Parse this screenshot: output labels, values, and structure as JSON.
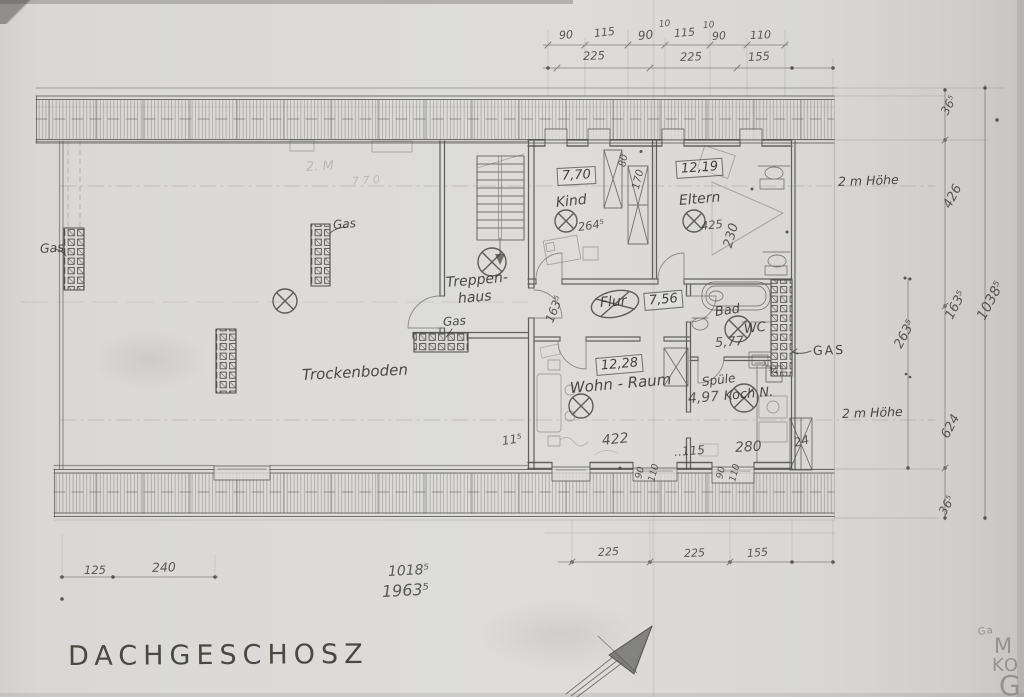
{
  "title": {
    "text": "DACHGESCHOSZ"
  },
  "plan": {
    "annotations": [
      {
        "name": "dim-top-90-a",
        "text": "90",
        "x": 559,
        "y": 30,
        "size": 11,
        "rot": -4,
        "cls": "dim"
      },
      {
        "name": "dim-top-115-a",
        "text": "115",
        "x": 594,
        "y": 28,
        "size": 11,
        "rot": -6,
        "cls": "dim"
      },
      {
        "name": "dim-top-90-b",
        "text": "90",
        "x": 638,
        "y": 30,
        "size": 12,
        "rot": -6,
        "cls": "dim"
      },
      {
        "name": "dim-top-10-a",
        "text": "10",
        "x": 659,
        "y": 21,
        "size": 9,
        "rot": -6,
        "cls": "dim"
      },
      {
        "name": "dim-top-115-b",
        "text": "115",
        "x": 674,
        "y": 28,
        "size": 11,
        "rot": -4,
        "cls": "dim"
      },
      {
        "name": "dim-top-10-b",
        "text": "10",
        "x": 703,
        "y": 22,
        "size": 9,
        "rot": -4,
        "cls": "dim"
      },
      {
        "name": "dim-top-90-c",
        "text": "90",
        "x": 712,
        "y": 31,
        "size": 11,
        "rot": -4,
        "cls": "dim"
      },
      {
        "name": "dim-top-110",
        "text": "110",
        "x": 750,
        "y": 30,
        "size": 11,
        "rot": -2,
        "cls": "dim"
      },
      {
        "name": "dim-top-225-a",
        "text": "225",
        "x": 583,
        "y": 51,
        "size": 11.5,
        "rot": -2,
        "cls": "dim"
      },
      {
        "name": "dim-top-225-b",
        "text": "225",
        "x": 680,
        "y": 52,
        "size": 11.5,
        "rot": -2,
        "cls": "dim"
      },
      {
        "name": "dim-top-155",
        "text": "155",
        "x": 748,
        "y": 52,
        "size": 11.5,
        "rot": -3,
        "cls": "dim"
      },
      {
        "name": "dim-bottom-225-a",
        "text": "225",
        "x": 598,
        "y": 547,
        "size": 11,
        "rot": -3,
        "cls": "dim"
      },
      {
        "name": "dim-bottom-225-b",
        "text": "225",
        "x": 684,
        "y": 548,
        "size": 11,
        "rot": -2,
        "cls": "dim"
      },
      {
        "name": "dim-bottom-155",
        "text": "155",
        "x": 747,
        "y": 548,
        "size": 11,
        "rot": -4,
        "cls": "dim"
      },
      {
        "name": "dim-bottom-125",
        "text": "125",
        "x": 84,
        "y": 565,
        "size": 11.5,
        "rot": 0,
        "cls": "dim"
      },
      {
        "name": "dim-bottom-240",
        "text": "240",
        "x": 152,
        "y": 562,
        "size": 12.5,
        "rot": -2,
        "cls": "dim"
      },
      {
        "name": "dim-overall-1018",
        "text": "1018⁵",
        "x": 388,
        "y": 565,
        "size": 14,
        "rot": -3,
        "cls": "dim"
      },
      {
        "name": "dim-overall-1963",
        "text": "1963⁵",
        "x": 382,
        "y": 584,
        "size": 16,
        "rot": -3,
        "cls": "dim"
      },
      {
        "name": "dim-right-36-top",
        "text": "36⁵",
        "x": 944,
        "y": 108,
        "size": 12,
        "rot": -62,
        "cls": "dim"
      },
      {
        "name": "dim-right-426",
        "text": "426",
        "x": 947,
        "y": 201,
        "size": 13,
        "rot": -62,
        "cls": "dim"
      },
      {
        "name": "dim-right-163",
        "text": "163⁵",
        "x": 949,
        "y": 312,
        "size": 13,
        "rot": -62,
        "cls": "dim"
      },
      {
        "name": "dim-right-1038",
        "text": "1038⁵",
        "x": 981,
        "y": 312,
        "size": 14,
        "rot": -62,
        "cls": "dim"
      },
      {
        "name": "dim-right-263",
        "text": "263⁵",
        "x": 898,
        "y": 341,
        "size": 13,
        "rot": -62,
        "cls": "dim"
      },
      {
        "name": "dim-right-624",
        "text": "624",
        "x": 945,
        "y": 431,
        "size": 13,
        "rot": -62,
        "cls": "dim"
      },
      {
        "name": "dim-right-36-bottom",
        "text": "36⁵",
        "x": 942,
        "y": 508,
        "size": 12,
        "rot": -62,
        "cls": "dim"
      },
      {
        "name": "note-2m-hoehe-top",
        "text": "2 m Höhe",
        "x": 838,
        "y": 176,
        "size": 12.5,
        "rot": -2,
        "cls": "hand"
      },
      {
        "name": "note-2m-hoehe-bottom",
        "text": "2 m Höhe",
        "x": 842,
        "y": 408,
        "size": 12.5,
        "rot": -2,
        "cls": "hand"
      },
      {
        "name": "dim-int-80",
        "text": "80",
        "x": 623,
        "y": 162,
        "size": 10,
        "rot": -78,
        "cls": "dim"
      },
      {
        "name": "dim-int-170",
        "text": "170",
        "x": 636,
        "y": 184,
        "size": 10.5,
        "rot": -76,
        "cls": "dim"
      },
      {
        "name": "dim-kind-264",
        "text": "264⁵",
        "x": 578,
        "y": 222,
        "size": 11.5,
        "rot": -8,
        "cls": "dim"
      },
      {
        "name": "dim-eltern-425",
        "text": "425",
        "x": 701,
        "y": 221,
        "size": 11.5,
        "rot": -6,
        "cls": "dim"
      },
      {
        "name": "dim-eltern-230",
        "text": "230",
        "x": 728,
        "y": 241,
        "size": 13,
        "rot": -74,
        "cls": "dim"
      },
      {
        "name": "dim-flur-163",
        "text": "163⁵",
        "x": 549,
        "y": 316,
        "size": 12,
        "rot": -68,
        "cls": "dim"
      },
      {
        "name": "dim-bad-577",
        "text": "5,77",
        "x": 715,
        "y": 337,
        "size": 13,
        "rot": -4,
        "cls": "dim"
      },
      {
        "name": "dim-int-11-left",
        "text": "11⁵",
        "x": 502,
        "y": 435,
        "size": 12,
        "rot": -8,
        "cls": "dim"
      },
      {
        "name": "dim-int-422",
        "text": "422",
        "x": 602,
        "y": 434,
        "size": 14,
        "rot": -6,
        "cls": "dim"
      },
      {
        "name": "dim-int-115",
        "text": "‥115",
        "x": 674,
        "y": 446,
        "size": 12,
        "rot": -4,
        "cls": "dim"
      },
      {
        "name": "dim-int-280",
        "text": "280",
        "x": 735,
        "y": 441,
        "size": 14,
        "rot": -3,
        "cls": "dim"
      },
      {
        "name": "dim-int-24",
        "text": "24",
        "x": 794,
        "y": 437,
        "size": 12,
        "rot": -14,
        "cls": "dim"
      },
      {
        "name": "dim-int-90-a",
        "text": "90",
        "x": 639,
        "y": 474,
        "size": 9.5,
        "rot": -76,
        "cls": "dim"
      },
      {
        "name": "dim-int-110-a",
        "text": "110",
        "x": 652,
        "y": 477,
        "size": 9.5,
        "rot": -76,
        "cls": "dim"
      },
      {
        "name": "dim-int-90-b",
        "text": "90",
        "x": 720,
        "y": 474,
        "size": 9.5,
        "rot": -76,
        "cls": "dim"
      },
      {
        "name": "dim-int-110-b",
        "text": "110",
        "x": 733,
        "y": 477,
        "size": 9.5,
        "rot": -76,
        "cls": "dim"
      },
      {
        "name": "area-kind",
        "text": "7,70",
        "x": 557,
        "y": 168,
        "size": 13,
        "rot": -3,
        "cls": "boxed"
      },
      {
        "name": "area-eltern",
        "text": "12,19",
        "x": 676,
        "y": 161,
        "size": 13,
        "rot": -4,
        "cls": "boxed"
      },
      {
        "name": "area-flur",
        "text": "7,56",
        "x": 644,
        "y": 293,
        "size": 13,
        "rot": -5,
        "cls": "boxed"
      },
      {
        "name": "area-wohn",
        "text": "12,28",
        "x": 596,
        "y": 358,
        "size": 13,
        "rot": -5,
        "cls": "boxed"
      },
      {
        "name": "room-kind",
        "text": "Kind",
        "x": 556,
        "y": 196,
        "size": 14,
        "rot": -6,
        "cls": "hand"
      },
      {
        "name": "room-eltern",
        "text": "Eltern",
        "x": 679,
        "y": 194,
        "size": 14,
        "rot": -5,
        "cls": "hand"
      },
      {
        "name": "room-flur",
        "text": "Flur",
        "x": 600,
        "y": 296,
        "size": 14,
        "rot": -4,
        "cls": "hand"
      },
      {
        "name": "room-bad",
        "text": "Bad",
        "x": 715,
        "y": 306,
        "size": 13,
        "rot": -8,
        "cls": "hand"
      },
      {
        "name": "room-wc",
        "text": "WC",
        "x": 744,
        "y": 323,
        "size": 13,
        "rot": -6,
        "cls": "hand"
      },
      {
        "name": "room-treppenhaus-line1",
        "text": "Treppen-",
        "x": 446,
        "y": 276,
        "size": 14,
        "rot": -5,
        "cls": "hand"
      },
      {
        "name": "room-treppenhaus-line2",
        "text": "haus",
        "x": 458,
        "y": 292,
        "size": 14,
        "rot": -5,
        "cls": "hand"
      },
      {
        "name": "room-trockenboden",
        "text": "Trockenboden",
        "x": 302,
        "y": 368,
        "size": 15,
        "rot": -3,
        "cls": "hand"
      },
      {
        "name": "room-wohnraum",
        "text": "Wohn - Raum",
        "x": 570,
        "y": 381,
        "size": 15,
        "rot": -5,
        "cls": "hand"
      },
      {
        "name": "label-spuele",
        "text": "Spüle",
        "x": 702,
        "y": 376,
        "size": 12,
        "rot": -7,
        "cls": "hand"
      },
      {
        "name": "dim-koch-497",
        "text": "4,97",
        "x": 688,
        "y": 392,
        "size": 14,
        "rot": -4,
        "cls": "dim"
      },
      {
        "name": "label-koch-n",
        "text": "Koch N.",
        "x": 724,
        "y": 390,
        "size": 13,
        "rot": -5,
        "cls": "hand"
      },
      {
        "name": "label-gas-left",
        "text": "Gas",
        "x": 40,
        "y": 243,
        "size": 12.5,
        "rot": -4,
        "cls": "hand"
      },
      {
        "name": "label-gas-mid",
        "text": "Gas",
        "x": 333,
        "y": 219,
        "size": 12,
        "rot": -5,
        "cls": "hand"
      },
      {
        "name": "label-gas-stair",
        "text": "Gas",
        "x": 443,
        "y": 316,
        "size": 12,
        "rot": -4,
        "cls": "hand"
      },
      {
        "name": "label-gas-right",
        "text": "GAS",
        "x": 813,
        "y": 345,
        "size": 12.5,
        "rot": -2,
        "cls": "gasprint"
      },
      {
        "name": "label-kitchen-fraction",
        "text": "¾",
        "x": 769,
        "y": 368,
        "size": 9,
        "rot": 0,
        "cls": "hand"
      },
      {
        "name": "note-erased-text",
        "text": "2. M",
        "x": 306,
        "y": 161,
        "size": 13,
        "rot": -3,
        "cls": "faint"
      },
      {
        "name": "note-erased-number",
        "text": "7 7 0",
        "x": 352,
        "y": 176,
        "size": 11,
        "rot": -4,
        "cls": "faint"
      },
      {
        "name": "corner-letterhead-ga",
        "text": "Ga",
        "x": 978,
        "y": 628,
        "size": 10,
        "rot": -8,
        "cls": "print"
      },
      {
        "name": "corner-letterhead-m",
        "text": "M",
        "x": 994,
        "y": 636,
        "size": 21,
        "rot": 0,
        "cls": "print"
      },
      {
        "name": "corner-letterhead-ko",
        "text": "KO",
        "x": 992,
        "y": 657,
        "size": 18,
        "rot": 0,
        "cls": "print"
      },
      {
        "name": "corner-letterhead-g",
        "text": "G",
        "x": 999,
        "y": 672,
        "size": 28,
        "rot": 0,
        "cls": "print"
      }
    ]
  }
}
